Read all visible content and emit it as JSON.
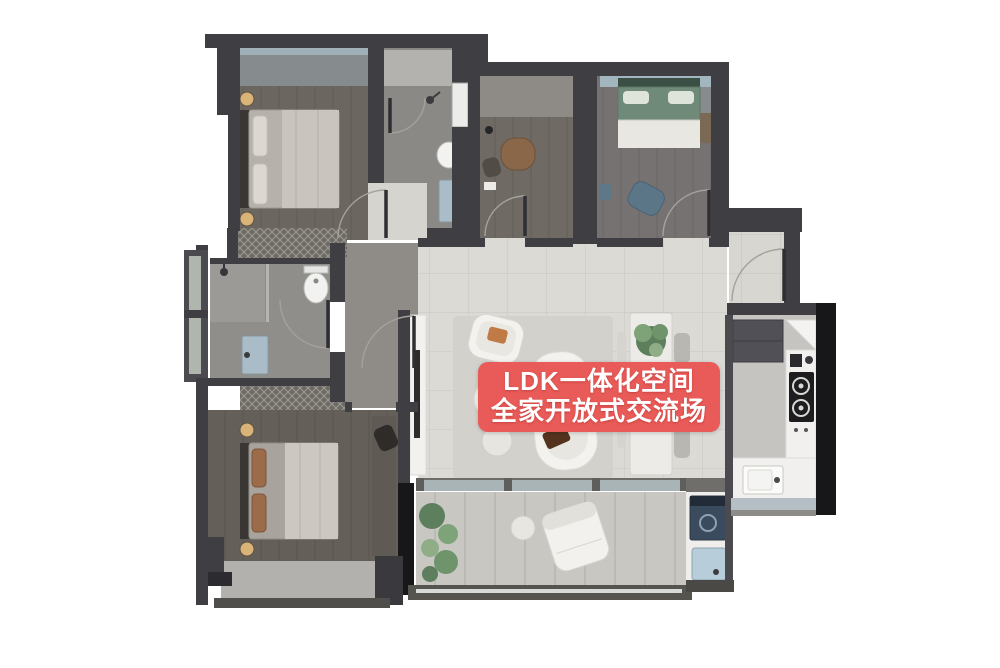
{
  "banner": {
    "line1": "LDK一体化空间",
    "line2": "全家开放式交流场"
  },
  "colors": {
    "banner_bg": "#e85b58",
    "banner_text": "#ffffff",
    "wall_dark": "#3e3e43",
    "wall_black": "#17171a",
    "living_tile": "#dcdad5",
    "bedroom_floor": "#6b6660",
    "bathroom_floor": "#8b8985",
    "balcony_floor": "#c9c7c2",
    "kitchen_counter": "#f1f0ee",
    "green_bed": "#6f8a79",
    "window_glass": "#a2b6bf",
    "sink_blue": "#a9bcc8"
  }
}
